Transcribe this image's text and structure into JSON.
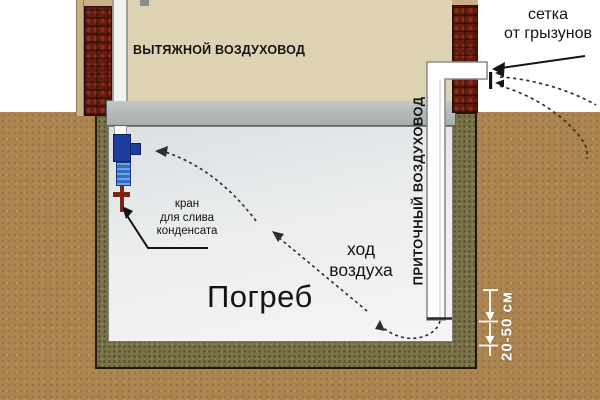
{
  "diagram": {
    "labels": {
      "exhaust_duct": "ВЫТЯЖНОЙ ВОЗДУХОВОД",
      "supply_duct": "ПРИТОЧНЫЙ ВОЗДУХОВОД",
      "cellar": "Погреб",
      "mesh_line1": "сетка",
      "mesh_line2": "от грызунов",
      "tap_line1": "кран",
      "tap_line2": "для слива",
      "tap_line3": "конденсата",
      "airflow_line1": "ход",
      "airflow_line2": "воздуха",
      "dimension": "20-50 см"
    },
    "colors": {
      "soil": "#ab8450",
      "cellar_wall": "#7a7247",
      "interior": "#edeff0",
      "house_wall": "#ddd2b2",
      "ceiling_beam": "#b6babb",
      "brick": "#621b0f",
      "valve_dark_blue": "#1e3e9d",
      "valve_light_blue": "#2f6fc5",
      "tap_red": "#7d2415",
      "pipe_white": "#ffffff",
      "annotation": "#141414",
      "dimension_white": "#ffffff"
    }
  }
}
